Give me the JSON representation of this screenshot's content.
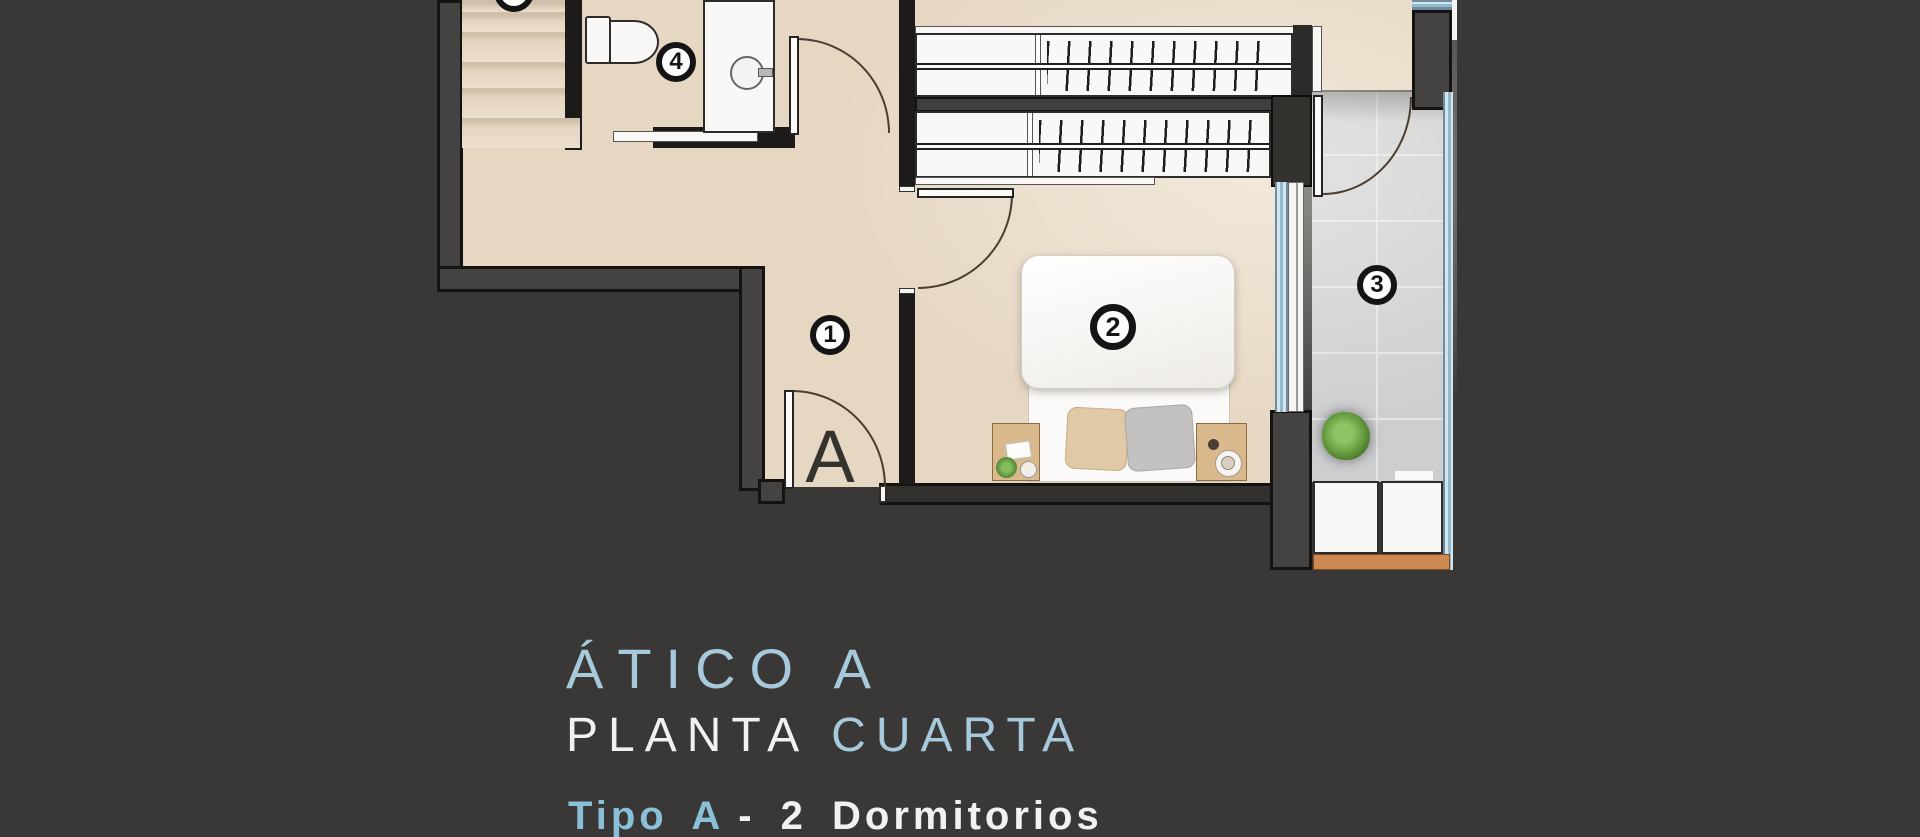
{
  "plan": {
    "markers": [
      {
        "area": "hallway",
        "label": "1"
      },
      {
        "area": "bedroom",
        "label": "2"
      },
      {
        "area": "terrace",
        "label": "3"
      },
      {
        "area": "bathroom",
        "label": "4"
      }
    ],
    "entrance_letter": "A",
    "icons": [
      "stairs-icon",
      "toilet-icon",
      "sink-icon",
      "wardrobe-hangers-icon",
      "double-bed-icon",
      "nightstand-icon",
      "plant-icon",
      "terrace-cabinets-icon",
      "door-swing-icon",
      "window-glass-icon"
    ]
  },
  "captions": {
    "title": "ÁTICO A",
    "floor_line_white": "PLANTA",
    "floor_line_blue": "CUARTA",
    "type_line_blue": "Tipo A",
    "type_line_white": "- 2  Dormitorios"
  },
  "colors": {
    "background": "#393837",
    "accent_blue": "#a6c9dc",
    "accent_blue_bold": "#8abfd8",
    "text_white": "#f2f1ef",
    "floor_beige": "#e6d7c3",
    "terrace_tile": "#cdced0",
    "wall_gray": "#454341",
    "wall_dark": "#1d1b19",
    "glass_blue": "#d3e6f0",
    "wood_trim": "#cc8a52"
  }
}
